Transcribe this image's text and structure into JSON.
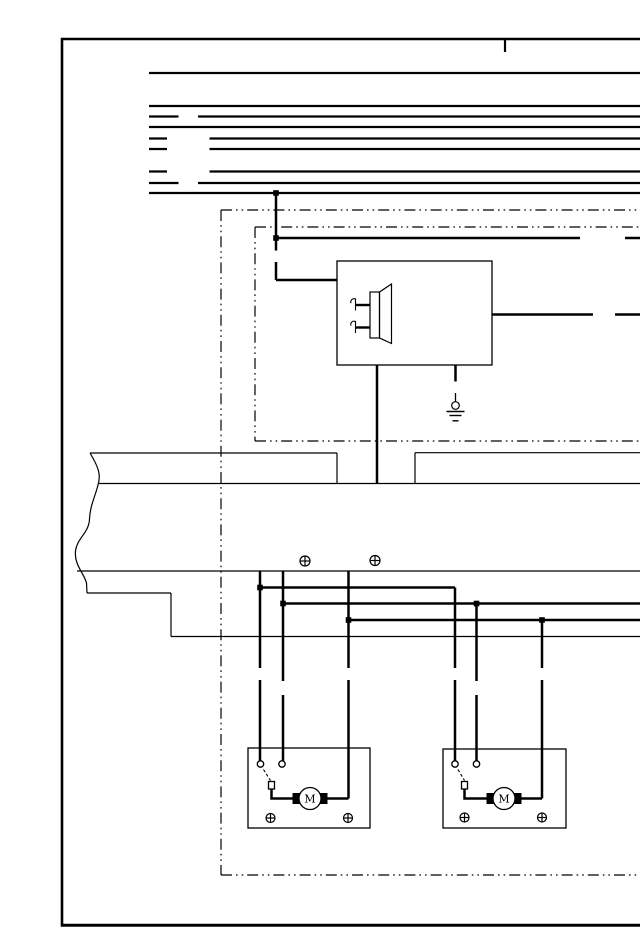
{
  "page": {
    "background_color": "#ffffff",
    "ink_color": "#000000",
    "description_present_text_only": "schematic symbols, no captions"
  },
  "icons": {
    "horn_speaker": "horn-speaker-icon",
    "ground": "chassis-ground-icon",
    "bolt": "circled-plus-bolt-icon",
    "motor": "motor-circle-icon",
    "junction": "filled-square-junction",
    "switch_contact": "open-circle-contact",
    "break_line": "wavy-break-line"
  },
  "motors": {
    "left": "M",
    "right": "M"
  }
}
